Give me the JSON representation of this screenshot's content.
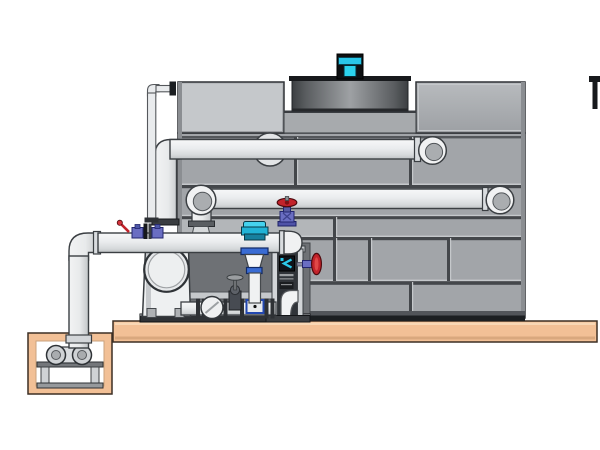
{
  "colors": {
    "background": "#ffffff",
    "panel": "#a2a5a9",
    "panel_light": "#b3b6b9",
    "panel_edge": "#8b8e92",
    "outline": "#2e3135",
    "seam_dark": "#44474b",
    "seam_light": "#c5c8cb",
    "base_band": "#1c1f22",
    "base_band_light": "#52555a",
    "deck": "#a7aaad",
    "cowl_rim": "#17191c",
    "slab": "#f2c096",
    "slab_highlight": "#f8d7b5",
    "slab_shadow": "#d9a87e",
    "slab_outline": "#3c2f24",
    "pit_inner": "#ffffff",
    "pipe": "#eef0f1",
    "pipe_shade": "#c2c5c8",
    "pipe_outline": "#3b3f43",
    "flange_dark": "#2e3135",
    "fitting_gray": "#d9dcdf",
    "backdrop": "#6e7175",
    "skid_rail": "#2f3236",
    "frame_light": "#d2d5d8",
    "frame_interior": "#303439",
    "unit_white": "#eef0f1",
    "cyan": "#29c6e8",
    "cyan_deep": "#1492b4",
    "motor_dark": "#0d0f11",
    "red": "#c2232b",
    "red_dark": "#4f0a0e",
    "purple": "#6a6ec2",
    "purple_dark": "#23266e",
    "blue": "#3a6cd4",
    "blue_box": "#2247b0",
    "metal_mid": "#cfd2d5",
    "metal_dark": "#74777b"
  },
  "components": {
    "tower_casing": "paneled cooling-tower casing",
    "fan_motor": "cyan fan motor",
    "fan_cowl": "recessed fan cowl",
    "upper_pipe": "upper horizontal pipe with end elbow",
    "lower_pipe": "lower horizontal pipe with end elbow",
    "standpipe": "thin equalizer standpipe",
    "suction_manifold": "pump suction manifold with end cap",
    "separator": "white separator / pump volute unit",
    "pump_skid": "skid base rail and dark equipment bay",
    "chemical_feed": "blue cone feed assembly",
    "control_column": "instrument column with display and pipe bend",
    "red_globe_valve": "red handwheel globe valve on pipe cap",
    "side_handwheel": "red side handwheel valve",
    "inline_valve": "small dark globe valve in bottom line",
    "sight_gauge": "round sight gauge in bottom line",
    "sump_pit": "concrete sump pit",
    "sump_pump": "small horizontal pump in pit",
    "foundation_slab": "tan concrete foundation slab",
    "vent_stub": "dark pipe stub at right image edge"
  }
}
